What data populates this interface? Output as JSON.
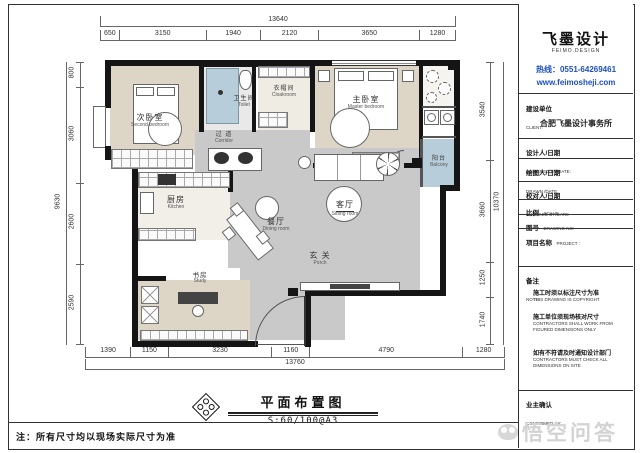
{
  "watermark": {
    "text": "悟空问答"
  },
  "sheet_note": "注：所有尺寸均以现场实际尺寸为准",
  "caption": {
    "title": "平面布置图",
    "scale": "S:60/100@A3"
  },
  "title_block": {
    "brand": {
      "name": "飞墨设计",
      "name_en": "FEIMO.DESIGN",
      "hotline": "热线：0551-64269461",
      "website": "www.feimosheji.com"
    },
    "client": {
      "label_zh": "建设单位",
      "label_en": "CLIENT:",
      "name": "合肥飞墨设计事务所"
    },
    "rows": [
      {
        "zh": "设计人/日期",
        "en": "DESIGNED BY/DATE:"
      },
      {
        "zh": "绘图人/日期",
        "en": "DRAWN /DATE:"
      },
      {
        "zh": "校对人/日期",
        "en": "CHECKED BY/DATE:"
      },
      {
        "zh": "比例",
        "en": "SCALE:"
      },
      {
        "zh": "图号",
        "en": "DRAWING NO:"
      },
      {
        "zh": "项目名称",
        "en": "PROJECT :"
      }
    ],
    "notes": {
      "label_zh": "备注",
      "label_en": "NOTE:",
      "items": [
        {
          "zh": "施工时须以标注尺寸为准",
          "en": "THIS DRAWING IS COPYRIGHT"
        },
        {
          "zh": "施工单位须现场核对尺寸",
          "en": "CONTRACTORS SHALL WORK FROM FIGURED DIMENSIONS ONLY"
        },
        {
          "zh": "如有不符请及时通知设计部门",
          "en": "CONTRACTORS MUST CHECK ALL DIMENSIONS ON SITE"
        }
      ]
    },
    "confirm": {
      "zh": "业主确认",
      "en": "CONFIRMED BY:"
    }
  },
  "plan": {
    "rooms": {
      "second_bedroom": {
        "zh": "次卧室",
        "en": "Second bedroom"
      },
      "toilet": {
        "zh": "卫生间",
        "en": "Toilet"
      },
      "cloakroom": {
        "zh": "衣帽间",
        "en": "Cloakroom"
      },
      "master_bedroom": {
        "zh": "主卧室",
        "en": "Master bedroom"
      },
      "balcony": {
        "zh": "阳台",
        "en": "Balcony"
      },
      "corridor": {
        "zh": "过 道",
        "en": "Corridor"
      },
      "kitchen": {
        "zh": "厨房",
        "en": "Kitchen"
      },
      "dining": {
        "zh": "餐厅",
        "en": "Dining room"
      },
      "living": {
        "zh": "客厅",
        "en": "Sitting room"
      },
      "porch": {
        "zh": "玄 关",
        "en": "Porch"
      },
      "study": {
        "zh": "书房",
        "en": "Study"
      }
    },
    "dims": {
      "top": {
        "total": "13640",
        "segments": [
          "650",
          "3150",
          "1940",
          "2120",
          "3650",
          "1280"
        ]
      },
      "bottom": {
        "total": "13760",
        "segments": [
          "1390",
          "1150",
          "3230",
          "1160",
          "4790",
          "1280"
        ]
      },
      "left": {
        "total": "9630",
        "segments": [
          "800",
          "3060",
          "2600",
          "2590"
        ]
      },
      "right": {
        "total": "10370",
        "segments": [
          "3540",
          "3660",
          "1250",
          "1740"
        ]
      }
    }
  }
}
